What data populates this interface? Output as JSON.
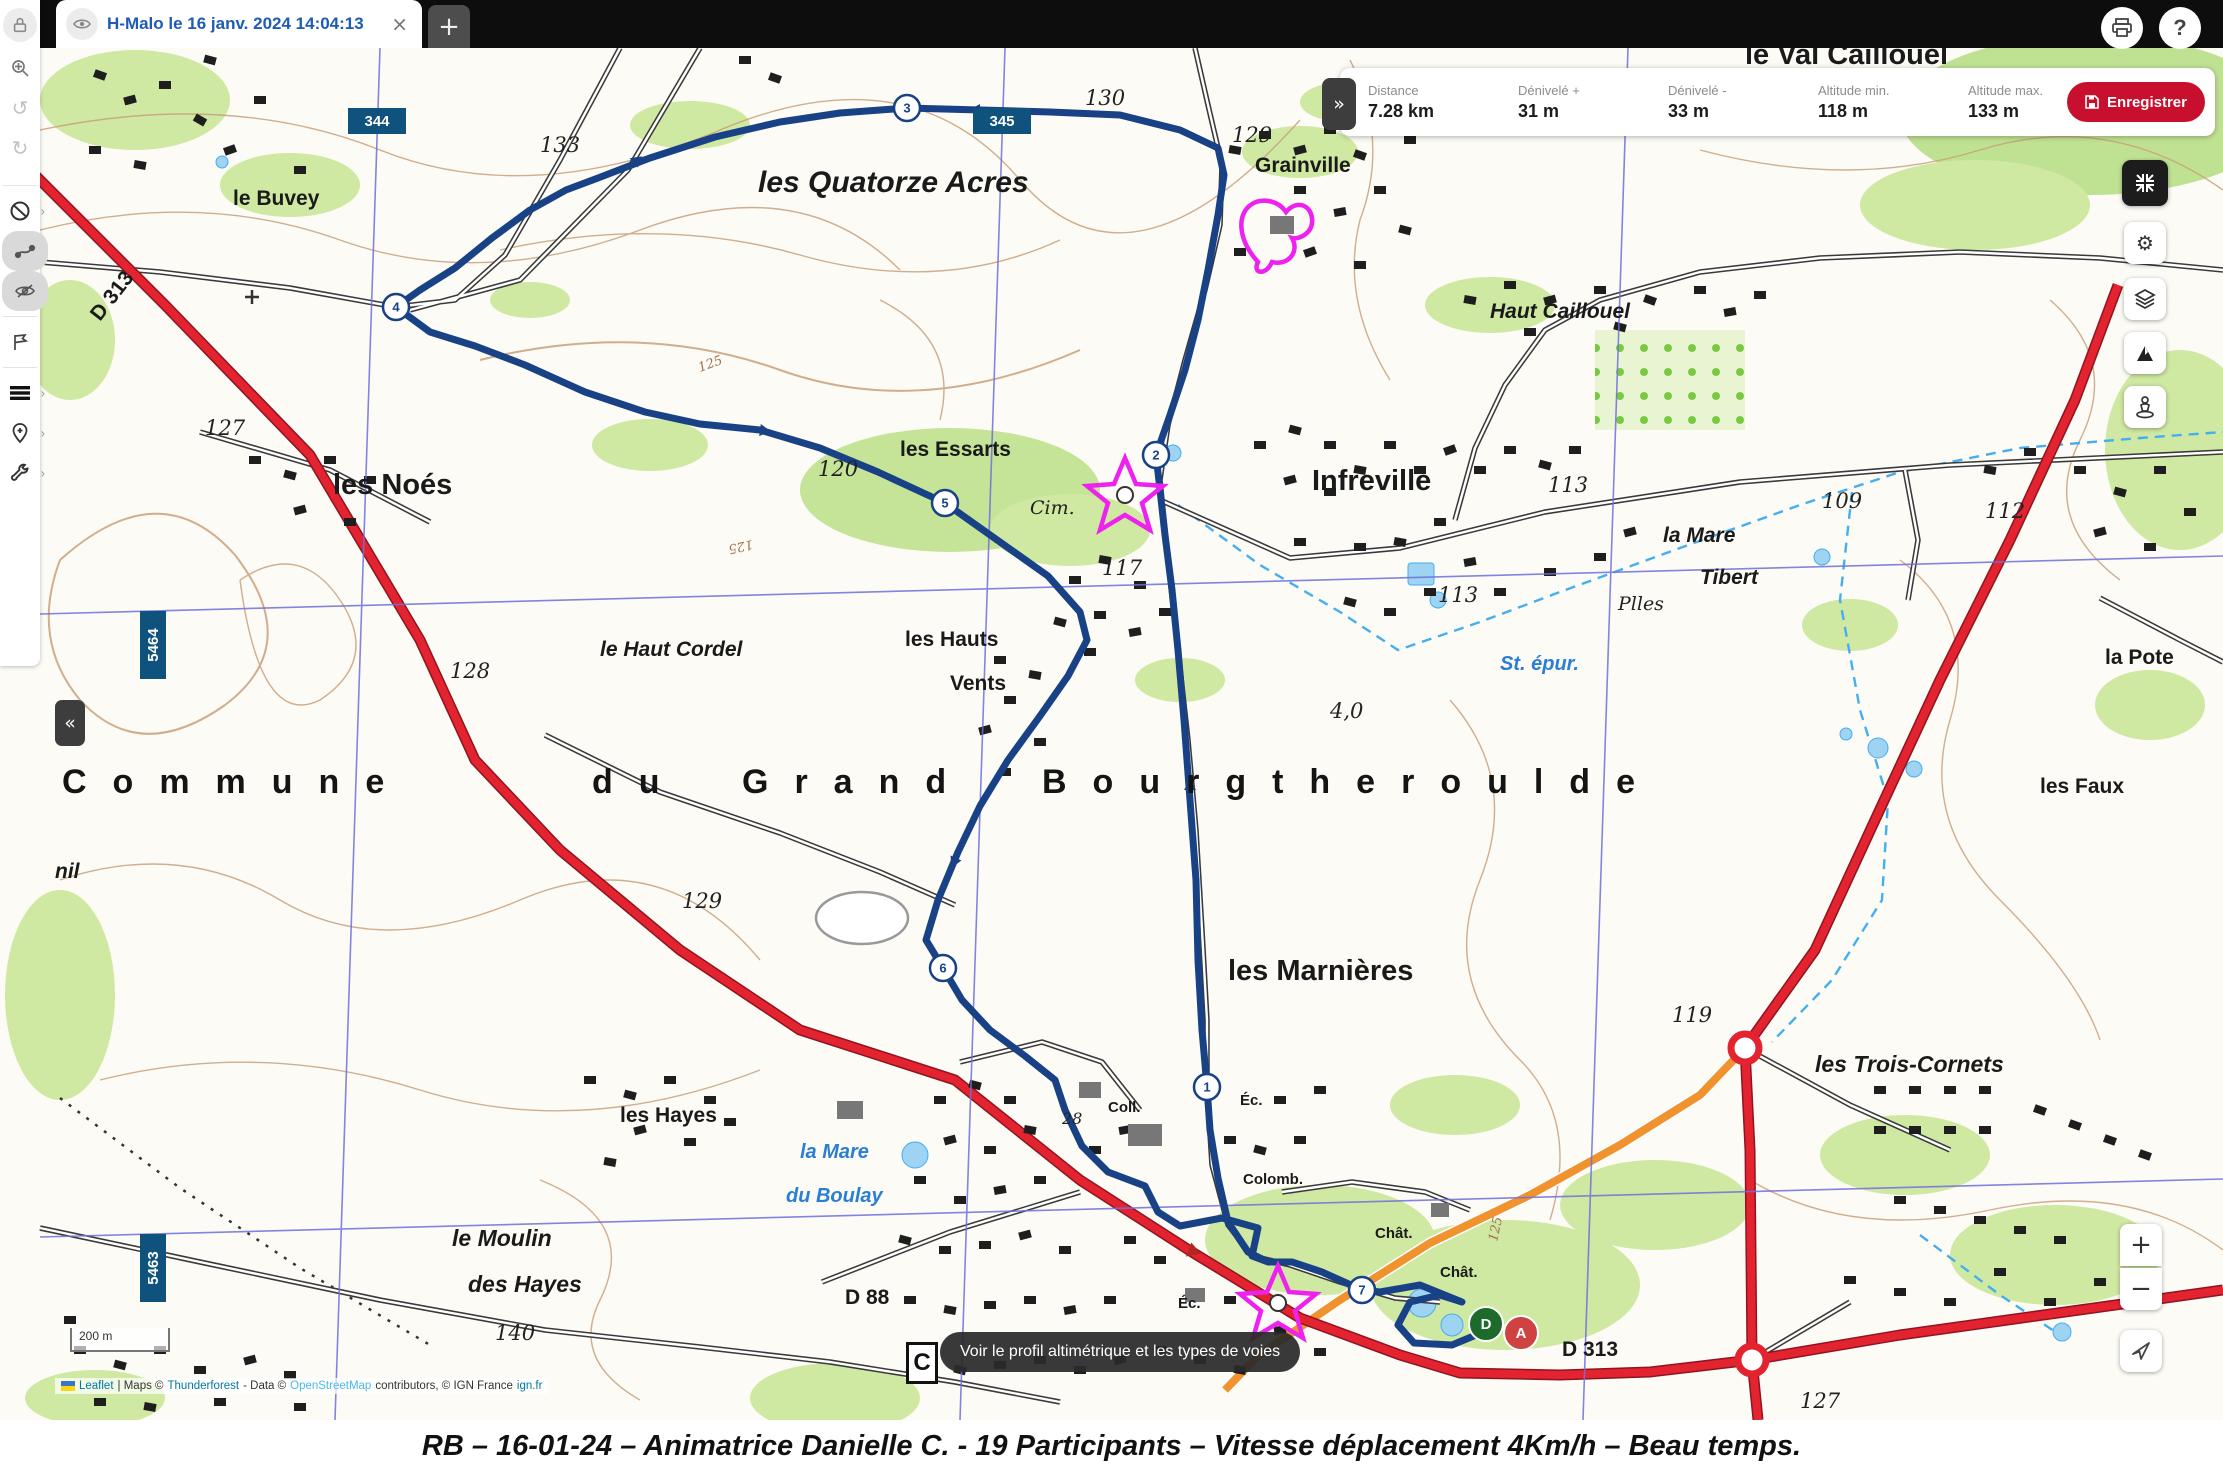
{
  "window": {
    "tab_title": "H-Malo le 16 janv. 2024 14:04:13",
    "tab_close": "×",
    "new_tab": "+"
  },
  "stats": {
    "collapse": "»",
    "items": [
      {
        "label": "Distance",
        "value": "7.28 km"
      },
      {
        "label": "Dénivelé +",
        "value": "31 m"
      },
      {
        "label": "Dénivelé -",
        "value": "33 m"
      },
      {
        "label": "Altitude min.",
        "value": "118 m"
      },
      {
        "label": "Altitude max.",
        "value": "133 m"
      }
    ],
    "save_label": "Enregistrer",
    "accent_color": "#c8102e"
  },
  "sidebar": {
    "collapse": "«",
    "icons": [
      "lock",
      "zoom-target",
      "undo",
      "redo",
      "no-entry",
      "edit-route",
      "eye-off",
      "flag",
      "menu",
      "add-pin",
      "wrench"
    ]
  },
  "right_toolbar": {
    "icons": [
      "exit-fullscreen",
      "settings",
      "layers",
      "relief",
      "street-view"
    ],
    "zoom_in": "+",
    "zoom_out": "−"
  },
  "route": {
    "color": "#184285",
    "waypoints": [
      {
        "n": "1",
        "x": 1207,
        "y": 1087
      },
      {
        "n": "2",
        "x": 1156,
        "y": 455
      },
      {
        "n": "3",
        "x": 907,
        "y": 108
      },
      {
        "n": "4",
        "x": 396,
        "y": 307
      },
      {
        "n": "5",
        "x": 945,
        "y": 503
      },
      {
        "n": "6",
        "x": 943,
        "y": 968
      },
      {
        "n": "7",
        "x": 1362,
        "y": 1290
      }
    ],
    "start": {
      "label": "D",
      "x": 1486,
      "y": 1324,
      "color": "#1c6b2a"
    },
    "end": {
      "label": "A",
      "x": 1521,
      "y": 1333,
      "color": "#cf4242"
    }
  },
  "map": {
    "tooltip": "Voir le profil altimétrique et les types de voies",
    "corner_symbol": "C",
    "scale_label": "200 m",
    "attribution": {
      "leaflet": "Leaflet",
      "maps": "| Maps ©",
      "thunderforest": "Thunderforest",
      "data": "- Data ©",
      "osm": "OpenStreetMap",
      "contrib": "contributors, © IGN France",
      "ign": "ign.fr"
    },
    "grid_badges": [
      {
        "t": "344",
        "x": 377,
        "y": 121,
        "o": "h"
      },
      {
        "t": "345",
        "x": 1002,
        "y": 121,
        "o": "h"
      },
      {
        "t": "5464",
        "x": 153,
        "y": 645,
        "o": "v"
      },
      {
        "t": "5463",
        "x": 153,
        "y": 1268,
        "o": "v"
      }
    ],
    "labels": [
      {
        "t": "le Buvey",
        "x": 233,
        "y": 205,
        "c": "town"
      },
      {
        "t": "les Quatorze Acres",
        "x": 758,
        "y": 192,
        "c": "acres"
      },
      {
        "t": "Grainville",
        "x": 1255,
        "y": 172,
        "c": "town"
      },
      {
        "t": "le Val Caillouel",
        "x": 1745,
        "y": 64,
        "c": "city"
      },
      {
        "t": "Haut Caillouel",
        "x": 1490,
        "y": 318,
        "c": "ham"
      },
      {
        "t": "les Noés",
        "x": 333,
        "y": 494,
        "c": "city"
      },
      {
        "t": "les Essarts",
        "x": 900,
        "y": 456,
        "c": "town"
      },
      {
        "t": "Infreville",
        "x": 1312,
        "y": 490,
        "c": "city"
      },
      {
        "t": "la Mare",
        "x": 1663,
        "y": 542,
        "c": "ham"
      },
      {
        "t": "Tibert",
        "x": 1700,
        "y": 584,
        "c": "ham"
      },
      {
        "t": "Plles",
        "x": 1618,
        "y": 610,
        "c": "site-it"
      },
      {
        "t": "St. épur.",
        "x": 1500,
        "y": 670,
        "c": "water"
      },
      {
        "t": "le Haut Cordel",
        "x": 600,
        "y": 656,
        "c": "ham"
      },
      {
        "t": "les Hauts",
        "x": 905,
        "y": 646,
        "c": "town"
      },
      {
        "t": "Vents",
        "x": 950,
        "y": 690,
        "c": "town"
      },
      {
        "t": "la Pote",
        "x": 2105,
        "y": 664,
        "c": "town"
      },
      {
        "t": "les Faux",
        "x": 2040,
        "y": 793,
        "c": "town"
      },
      {
        "t": "nil",
        "x": 55,
        "y": 878,
        "c": "ham"
      },
      {
        "t": "les Marnières",
        "x": 1228,
        "y": 980,
        "c": "city"
      },
      {
        "t": "les Trois-Cornets",
        "x": 1815,
        "y": 1072,
        "c": "ham2"
      },
      {
        "t": "les Hayes",
        "x": 620,
        "y": 1122,
        "c": "town"
      },
      {
        "t": "la Mare",
        "x": 800,
        "y": 1158,
        "c": "water"
      },
      {
        "t": "du Boulay",
        "x": 786,
        "y": 1202,
        "c": "water"
      },
      {
        "t": "le Moulin",
        "x": 452,
        "y": 1246,
        "c": "ham2"
      },
      {
        "t": "des Hayes",
        "x": 468,
        "y": 1292,
        "c": "ham2"
      },
      {
        "t": "Commune",
        "x": 62,
        "y": 793,
        "c": "big"
      },
      {
        "t": "du",
        "x": 592,
        "y": 793,
        "c": "big"
      },
      {
        "t": "Grand",
        "x": 742,
        "y": 793,
        "c": "big"
      },
      {
        "t": "Bourgtheroulde",
        "x": 1042,
        "y": 793,
        "c": "big"
      },
      {
        "t": "127",
        "x": 205,
        "y": 435,
        "c": "elev"
      },
      {
        "t": "133",
        "x": 540,
        "y": 152,
        "c": "elev"
      },
      {
        "t": "130",
        "x": 1085,
        "y": 105,
        "c": "elev"
      },
      {
        "t": "129",
        "x": 1232,
        "y": 142,
        "c": "elev"
      },
      {
        "t": "120",
        "x": 818,
        "y": 476,
        "c": "elev"
      },
      {
        "t": "113",
        "x": 1548,
        "y": 492,
        "c": "elev"
      },
      {
        "t": "113",
        "x": 1438,
        "y": 602,
        "c": "elev"
      },
      {
        "t": "109",
        "x": 1822,
        "y": 508,
        "c": "elev"
      },
      {
        "t": "112",
        "x": 1985,
        "y": 518,
        "c": "elev"
      },
      {
        "t": "117",
        "x": 1102,
        "y": 575,
        "c": "elev"
      },
      {
        "t": "128",
        "x": 450,
        "y": 678,
        "c": "elev"
      },
      {
        "t": "4,0",
        "x": 1330,
        "y": 718,
        "c": "elev"
      },
      {
        "t": "129",
        "x": 682,
        "y": 908,
        "c": "elev"
      },
      {
        "t": "119",
        "x": 1672,
        "y": 1022,
        "c": "elev"
      },
      {
        "t": "140",
        "x": 495,
        "y": 1340,
        "c": "elev"
      },
      {
        "t": "127",
        "x": 1800,
        "y": 1408,
        "c": "elev"
      },
      {
        "t": "28",
        "x": 1062,
        "y": 1124,
        "c": "elev-s"
      },
      {
        "t": "125",
        "x": 700,
        "y": 372,
        "c": "cont",
        "r": -20
      },
      {
        "t": "125",
        "x": 752,
        "y": 540,
        "c": "cont",
        "r": 168
      },
      {
        "t": "125",
        "x": 1392,
        "y": 80,
        "c": "cont",
        "r": 78
      },
      {
        "t": "125",
        "x": 1497,
        "y": 1242,
        "c": "cont",
        "r": -78
      },
      {
        "t": "D 313",
        "x": 100,
        "y": 322,
        "c": "road",
        "r": -52
      },
      {
        "t": "D 88",
        "x": 845,
        "y": 1304,
        "c": "road"
      },
      {
        "t": "D 313",
        "x": 1562,
        "y": 1356,
        "c": "road"
      },
      {
        "t": "Cim.",
        "x": 1030,
        "y": 514,
        "c": "site-it"
      },
      {
        "t": "Coll.",
        "x": 1108,
        "y": 1112,
        "c": "site"
      },
      {
        "t": "Éc.",
        "x": 1240,
        "y": 1105,
        "c": "site"
      },
      {
        "t": "Éc.",
        "x": 1178,
        "y": 1308,
        "c": "site"
      },
      {
        "t": "Colomb.",
        "x": 1243,
        "y": 1184,
        "c": "site"
      },
      {
        "t": "Chât.",
        "x": 1375,
        "y": 1238,
        "c": "site"
      },
      {
        "t": "Chât.",
        "x": 1440,
        "y": 1277,
        "c": "site"
      }
    ]
  },
  "caption": "RB – 16-01-24 – Animatrice Danielle C. - 19 Participants – Vitesse déplacement 4Km/h – Beau temps."
}
